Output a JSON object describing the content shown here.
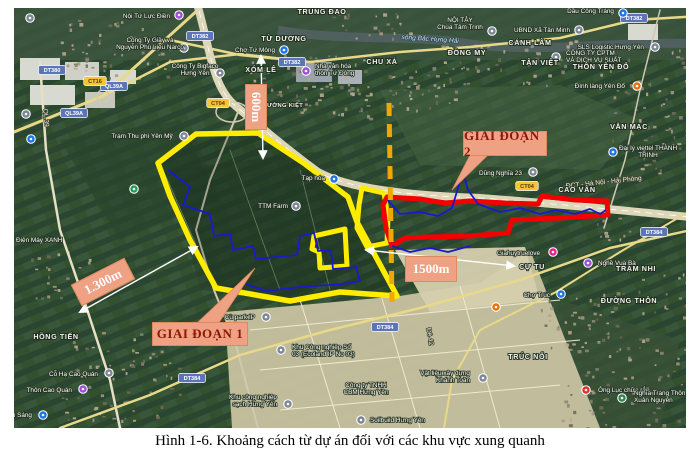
{
  "figure": {
    "caption": "Hình 1-6. Khoảng cách từ dự án đối với các khu vực xung quanh"
  },
  "map": {
    "colors": {
      "phase1_boundary": "#ffec00",
      "phase2_boundary": "#f40000",
      "planning_boundary_blue": "#1a1acd",
      "divider_dashed": "#f0a800",
      "annotation_fill": "#efa183",
      "annotation_text_measure": "#ffffff",
      "annotation_text_callout": "#8d1607"
    },
    "annotations": {
      "boxes": [
        {
          "name": "distance-label-600m",
          "label": "600m",
          "x": 233,
          "y": 96,
          "w": 46,
          "h": 22,
          "rot": 90,
          "kind": "measure"
        },
        {
          "name": "distance-label-1300m",
          "label": "1.300m",
          "x": 73,
          "y": 270,
          "w": 60,
          "h": 24,
          "rot": -27,
          "kind": "measure"
        },
        {
          "name": "distance-label-1500m",
          "label": "1500m",
          "x": 405,
          "y": 256,
          "w": 52,
          "h": 26,
          "rot": 0,
          "kind": "measure"
        },
        {
          "name": "phase-1-callout",
          "label": "GIAI ĐOẠN 1",
          "x": 152,
          "y": 322,
          "w": 96,
          "h": 24,
          "rot": 0,
          "kind": "callout"
        },
        {
          "name": "phase-2-callout",
          "label": "GIAI ĐOẠN 2",
          "x": 463,
          "y": 131,
          "w": 84,
          "h": 25,
          "rot": 0,
          "kind": "callout"
        }
      ],
      "callout_tails": [
        {
          "name": "phase-1-callout-tail",
          "pts": [
            [
              196,
              324
            ],
            [
              218,
              324
            ],
            [
              255,
              268
            ]
          ]
        },
        {
          "name": "phase-2-callout-tail",
          "pts": [
            [
              470,
              155
            ],
            [
              488,
              155
            ],
            [
              452,
              190
            ]
          ]
        }
      ],
      "measure_arrows": [
        {
          "name": "arrow-600m",
          "x1": 261,
          "y1": 56,
          "x2": 263,
          "y2": 158
        },
        {
          "name": "arrow-1300m",
          "x1": 197,
          "y1": 247,
          "x2": 80,
          "y2": 312
        },
        {
          "name": "arrow-1500m",
          "x1": 366,
          "y1": 250,
          "x2": 514,
          "y2": 266
        }
      ]
    },
    "overlays": [
      {
        "name": "phase1-boundary-main",
        "color": "#ffec00",
        "w": 5.5,
        "closed": true,
        "fill": "rgba(14,32,18,0.22)",
        "pts": [
          [
            158,
            163
          ],
          [
            196,
            134
          ],
          [
            258,
            133
          ],
          [
            305,
            164
          ],
          [
            348,
            197
          ],
          [
            357,
            222
          ],
          [
            397,
            296
          ],
          [
            340,
            292
          ],
          [
            290,
            301
          ],
          [
            216,
            288
          ],
          [
            190,
            240
          ],
          [
            170,
            196
          ]
        ]
      },
      {
        "name": "phase1-boundary-inner",
        "color": "#ffec00",
        "w": 5,
        "closed": true,
        "pts": [
          [
            314,
            236
          ],
          [
            345,
            229
          ],
          [
            347,
            266
          ],
          [
            320,
            268
          ],
          [
            319,
            252
          ],
          [
            312,
            249
          ]
        ]
      },
      {
        "name": "phase1-boundary-east",
        "color": "#ffec00",
        "w": 5,
        "closed": true,
        "pts": [
          [
            362,
            188
          ],
          [
            384,
            193
          ],
          [
            388,
            218
          ],
          [
            387,
            243
          ],
          [
            367,
            247
          ],
          [
            357,
            228
          ],
          [
            359,
            205
          ]
        ]
      },
      {
        "name": "phase2-boundary-red",
        "color": "#f40000",
        "w": 5,
        "closed": true,
        "pts": [
          [
            387,
            197
          ],
          [
            420,
            199
          ],
          [
            445,
            203
          ],
          [
            470,
            201
          ],
          [
            505,
            203
          ],
          [
            538,
            204
          ],
          [
            542,
            196
          ],
          [
            575,
            200
          ],
          [
            607,
            201
          ],
          [
            608,
            215
          ],
          [
            560,
            218
          ],
          [
            512,
            220
          ],
          [
            508,
            233
          ],
          [
            470,
            236
          ],
          [
            428,
            237
          ],
          [
            405,
            238
          ],
          [
            392,
            246
          ],
          [
            386,
            228
          ],
          [
            383,
            205
          ]
        ]
      },
      {
        "name": "blue-boundary-west",
        "color": "#1a1acd",
        "w": 1.8,
        "closed": false,
        "pts": [
          [
            168,
            170
          ],
          [
            190,
            187
          ],
          [
            183,
            205
          ],
          [
            210,
            214
          ],
          [
            214,
            236
          ],
          [
            230,
            234
          ],
          [
            233,
            250
          ],
          [
            253,
            246
          ],
          [
            256,
            259
          ],
          [
            297,
            255
          ],
          [
            300,
            236
          ],
          [
            314,
            233
          ],
          [
            318,
            251
          ],
          [
            331,
            250
          ],
          [
            333,
            269
          ],
          [
            356,
            267
          ],
          [
            360,
            281
          ],
          [
            342,
            284
          ],
          [
            300,
            287
          ],
          [
            266,
            291
          ],
          [
            246,
            284
          ]
        ]
      },
      {
        "name": "blue-boundary-east",
        "color": "#1a1acd",
        "w": 1.8,
        "closed": false,
        "pts": [
          [
            388,
            200
          ],
          [
            400,
            214
          ],
          [
            420,
            212
          ],
          [
            438,
            216
          ],
          [
            452,
            208
          ],
          [
            458,
            188
          ],
          [
            463,
            172
          ],
          [
            468,
            190
          ],
          [
            478,
            204
          ],
          [
            500,
            212
          ],
          [
            520,
            208
          ],
          [
            540,
            214
          ],
          [
            556,
            210
          ],
          [
            575,
            214
          ],
          [
            590,
            209
          ],
          [
            600,
            214
          ],
          [
            606,
            210
          ]
        ]
      },
      {
        "name": "blue-boundary-south",
        "color": "#1a1acd",
        "w": 1.8,
        "closed": false,
        "pts": [
          [
            392,
            246
          ],
          [
            410,
            252
          ],
          [
            430,
            248
          ],
          [
            448,
            252
          ],
          [
            470,
            246
          ]
        ]
      },
      {
        "name": "phase-divider-dashed",
        "color": "#f0a800",
        "w": 5,
        "closed": false,
        "dash": "13 8",
        "pts": [
          [
            389,
            103
          ],
          [
            392,
            302
          ]
        ]
      }
    ],
    "road_shields": [
      {
        "text": "DT380",
        "x": 52,
        "y": 70,
        "style": "blue"
      },
      {
        "text": "QL39A",
        "x": 114,
        "y": 86,
        "style": "blue"
      },
      {
        "text": "QL39A",
        "x": 74,
        "y": 113,
        "style": "blue"
      },
      {
        "text": "CT16",
        "x": 95,
        "y": 81,
        "style": "yellow"
      },
      {
        "text": "CT04",
        "x": 218,
        "y": 103,
        "style": "yellow"
      },
      {
        "text": "CT04",
        "x": 527,
        "y": 186,
        "style": "yellow"
      },
      {
        "text": "DT382",
        "x": 200,
        "y": 36,
        "style": "blue"
      },
      {
        "text": "DT382",
        "x": 292,
        "y": 62,
        "style": "blue"
      },
      {
        "text": "DT382",
        "x": 634,
        "y": 18,
        "style": "blue"
      },
      {
        "text": "DT384",
        "x": 192,
        "y": 378,
        "style": "blue"
      },
      {
        "text": "DT384",
        "x": 385,
        "y": 327,
        "style": "blue"
      },
      {
        "text": "DT384",
        "x": 654,
        "y": 232,
        "style": "blue"
      }
    ],
    "area_labels": [
      {
        "text": "TRUNG ĐẠO",
        "x": 322,
        "y": 14
      },
      {
        "text": "TỪ DƯƠNG",
        "x": 284,
        "y": 41
      },
      {
        "text": "XÓM LÊ",
        "x": 261,
        "y": 72
      },
      {
        "text": "CHU XÁ",
        "x": 382,
        "y": 64
      },
      {
        "text": "ĐỒNG MY",
        "x": 467,
        "y": 55
      },
      {
        "text": "CÁNH LÂM",
        "x": 530,
        "y": 45
      },
      {
        "text": "TÂN VIỆT",
        "x": 540,
        "y": 65
      },
      {
        "text": "THÔN YÊN ĐỔ",
        "x": 601,
        "y": 69
      },
      {
        "text": "VĂN MẠC",
        "x": 629,
        "y": 129
      },
      {
        "text": "CAO VÂN",
        "x": 577,
        "y": 192
      },
      {
        "text": "HỒNG TIẾN",
        "x": 56,
        "y": 339
      },
      {
        "text": "TRÚC NỔI",
        "x": 528,
        "y": 359
      },
      {
        "text": "ĐƯỜNG THÔN",
        "x": 629,
        "y": 303
      },
      {
        "text": "TRẠM NHI",
        "x": 636,
        "y": 271
      },
      {
        "text": "CỰ TU",
        "x": 532,
        "y": 269
      },
      {
        "text": "LÝ THƯỜNG KIỆT",
        "x": 276,
        "y": 107,
        "small": true
      }
    ],
    "road_names": [
      {
        "text": "sông Bắc Hưng Hải",
        "x": 430,
        "y": 41,
        "rot": 4,
        "cls": "water"
      },
      {
        "text": "ĐCT - Hà Nội - Hải Phòng",
        "x": 604,
        "y": 184,
        "rot": -6,
        "cls": "roadname"
      },
      {
        "text": "QL.39",
        "x": 44,
        "y": 118,
        "rot": 85,
        "cls": "roadname"
      },
      {
        "text": "Đê 42",
        "x": 428,
        "y": 337,
        "rot": 80,
        "cls": "roadname"
      }
    ],
    "pois": [
      {
        "text": "Nội Tứ Lực Điền",
        "tx": 170,
        "ty": 18,
        "anchor": "end",
        "icon": {
          "x": 179,
          "y": 15,
          "c": "#9c4fd4"
        }
      },
      {
        "text": "Công Ty Giầy và\nNguyễn Phú Liệu Narco",
        "tx": 150,
        "ty": 42,
        "anchor": "middle",
        "icon": {
          "x": 184,
          "y": 48,
          "c": "#7c8696"
        }
      },
      {
        "text": "Công Ty Bigfaco\nHưng Yên",
        "tx": 195,
        "ty": 68,
        "anchor": "middle",
        "icon": {
          "x": 220,
          "y": 73,
          "c": "#7c8696"
        }
      },
      {
        "text": "Chợ Tứ Mông",
        "tx": 275,
        "ty": 52,
        "anchor": "end",
        "icon": {
          "x": 284,
          "y": 50,
          "c": "#1a73e8"
        }
      },
      {
        "text": "Nhà văn hóa\nthôn Tứ Đông",
        "tx": 315,
        "ty": 68,
        "anchor": "start",
        "icon": {
          "x": 306,
          "y": 71,
          "c": "#9c4fd4"
        }
      },
      {
        "text": "Trạm Thu phí Yên Mỹ",
        "tx": 142,
        "ty": 138,
        "anchor": "middle",
        "icon": {
          "x": 184,
          "y": 136,
          "c": "#7c8696"
        }
      },
      {
        "text": "TTM Farm",
        "tx": 288,
        "ty": 208,
        "anchor": "end",
        "icon": {
          "x": 296,
          "y": 206,
          "c": "#7c8696"
        }
      },
      {
        "text": "Tạp hóa",
        "tx": 325,
        "ty": 180,
        "anchor": "end",
        "icon": {
          "x": 334,
          "y": 179,
          "c": "#1a73e8"
        }
      },
      {
        "text": "NỘI TÂY\nChùa Tâm Trinh",
        "tx": 460,
        "ty": 22,
        "anchor": "middle",
        "icon": {
          "x": 492,
          "y": 31,
          "c": "#7c8696"
        }
      },
      {
        "text": "UBND Xã Tân Minh",
        "tx": 570,
        "ty": 32,
        "anchor": "end",
        "icon": {
          "x": 579,
          "y": 30,
          "c": "#7c8696"
        }
      },
      {
        "text": "Dầu Công Tráng",
        "tx": 614,
        "ty": 13,
        "anchor": "end",
        "icon": {
          "x": 623,
          "y": 13,
          "c": "#1a73e8"
        }
      },
      {
        "text": "SLS Logistic Hưng Yên",
        "tx": 644,
        "ty": 49,
        "anchor": "end",
        "icon": {
          "x": 655,
          "y": 47,
          "c": "#7c8696"
        }
      },
      {
        "text": "CÔNG TY CPTM\nVÀ DỊCH VỤ SUẤT",
        "tx": 566,
        "ty": 55,
        "anchor": "start",
        "icon": {
          "x": 556,
          "y": 57,
          "c": "#7c8696"
        }
      },
      {
        "text": "Đình làng Yên Đổ",
        "tx": 625,
        "ty": 88,
        "anchor": "end",
        "icon": {
          "x": 637,
          "y": 86,
          "c": "#e8710a"
        }
      },
      {
        "text": "Đại lý viettel THÀNH\nTRINH",
        "tx": 648,
        "ty": 150,
        "anchor": "middle",
        "icon": {
          "x": 613,
          "y": 152,
          "c": "#1a73e8"
        }
      },
      {
        "text": "Dũng Nghĩa 23",
        "tx": 522,
        "ty": 175,
        "anchor": "end",
        "icon": {
          "x": 533,
          "y": 172,
          "c": "#7c8696"
        }
      },
      {
        "text": "Điện Máy XANH",
        "tx": 16,
        "ty": 242,
        "anchor": "start"
      },
      {
        "text": "Cỗ Hạ Cao Quán",
        "tx": 98,
        "ty": 376,
        "anchor": "end",
        "icon": {
          "x": 109,
          "y": 373,
          "c": "#7c8696"
        }
      },
      {
        "text": "Thôn Cao Quán",
        "tx": 72,
        "ty": 392,
        "anchor": "end",
        "icon": {
          "x": 83,
          "y": 389,
          "c": "#9c4fd4"
        }
      },
      {
        "text": "n Sáng",
        "tx": 32,
        "ty": 417,
        "anchor": "end",
        "icon": {
          "x": 43,
          "y": 415,
          "c": "#1a73e8"
        }
      },
      {
        "text": "Khu Công nghiệp Số\n03 (Ecoland IP No 03)",
        "tx": 292,
        "ty": 349,
        "anchor": "start",
        "icon": {
          "x": 281,
          "y": 350,
          "c": "#7c8696"
        }
      },
      {
        "text": "Khu công nghiệp\nsạch Hưng Yên",
        "tx": 277,
        "ty": 399,
        "anchor": "end",
        "icon": {
          "x": 288,
          "y": 404,
          "c": "#7c8696"
        }
      },
      {
        "text": "Công ty TNHH\nCBM Hưng Yên",
        "tx": 366,
        "ty": 387,
        "anchor": "middle"
      },
      {
        "text": "Soilbuild Hưng Yên",
        "tx": 370,
        "ty": 422,
        "anchor": "start",
        "icon": {
          "x": 361,
          "y": 420,
          "c": "#7c8696"
        }
      },
      {
        "text": "Vật liệu xây dựng\nKhánh Toàn",
        "tx": 470,
        "ty": 375,
        "anchor": "end",
        "icon": {
          "x": 483,
          "y": 378,
          "c": "#7c8696"
        }
      },
      {
        "text": "Giahuytruelove",
        "tx": 540,
        "ty": 255,
        "anchor": "end",
        "icon": {
          "x": 553,
          "y": 252,
          "c": "#e91e8c"
        }
      },
      {
        "text": "Nghề Vua Bà",
        "tx": 598,
        "ty": 265,
        "anchor": "start",
        "icon": {
          "x": 588,
          "y": 263,
          "c": "#9c4fd4"
        }
      },
      {
        "text": "Chợ Trúc",
        "tx": 550,
        "ty": 297,
        "anchor": "end",
        "icon": {
          "x": 561,
          "y": 294,
          "c": "#1a73e8"
        }
      },
      {
        "text": "Ông Lục chữa rắn",
        "tx": 598,
        "ty": 392,
        "anchor": "start",
        "icon": {
          "x": 586,
          "y": 390,
          "c": "#e03131"
        }
      },
      {
        "text": "Nghĩa Trang Thôn\nXuân Nguyên",
        "tx": 634,
        "ty": 395,
        "anchor": "start",
        "icon": {
          "x": 622,
          "y": 398,
          "c": "#2d8653"
        }
      },
      {
        "text": "Cù park IP",
        "tx": 255,
        "ty": 319,
        "anchor": "end",
        "icon": {
          "x": 266,
          "y": 317,
          "c": "#7c8696"
        }
      },
      {
        "text": "",
        "tx": 0,
        "ty": 0,
        "anchor": "start",
        "icon": {
          "x": 134,
          "y": 189,
          "c": "#1e9e52"
        }
      },
      {
        "text": "",
        "tx": 0,
        "ty": 0,
        "anchor": "start",
        "icon": {
          "x": 31,
          "y": 139,
          "c": "#1a73e8"
        }
      },
      {
        "text": "",
        "tx": 0,
        "ty": 0,
        "anchor": "start",
        "icon": {
          "x": 26,
          "y": 114,
          "c": "#7c8696"
        }
      },
      {
        "text": "",
        "tx": 0,
        "ty": 0,
        "anchor": "start",
        "icon": {
          "x": 30,
          "y": 18,
          "c": "#7c8696"
        }
      },
      {
        "text": "",
        "tx": 0,
        "ty": 0,
        "anchor": "start",
        "icon": {
          "x": 496,
          "y": 307,
          "c": "#e8710a"
        }
      }
    ]
  }
}
